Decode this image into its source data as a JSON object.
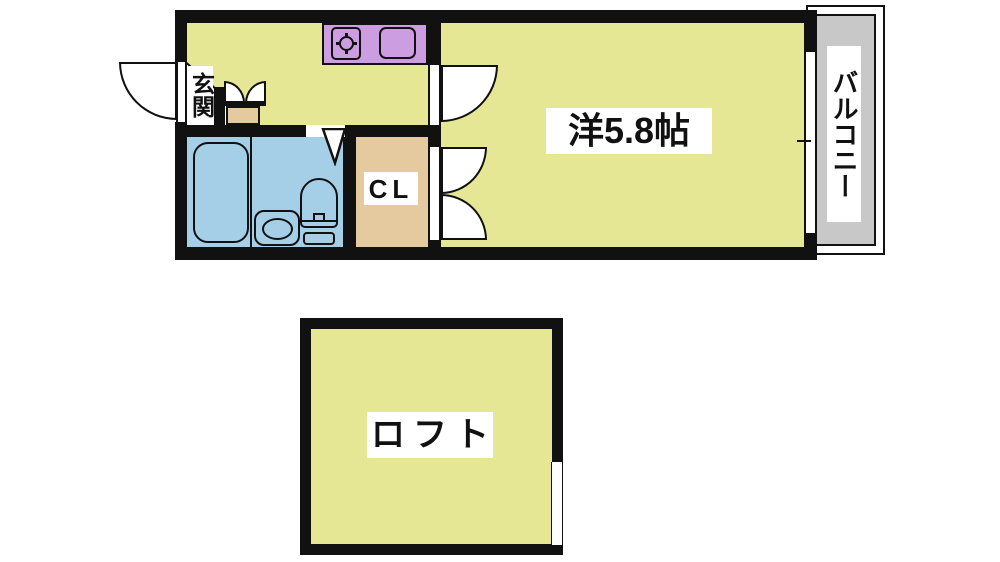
{
  "floorplan": {
    "labels": {
      "entrance": "玄関",
      "closet": "CL",
      "main_room": "洋5.8帖",
      "balcony": "バルコニー",
      "loft": "ロフト"
    },
    "colors": {
      "floor_yellow": "#E6E794",
      "bathroom_blue": "#A5CFE6",
      "closet_tan": "#E5CA9F",
      "kitchen_counter_purple": "#CC9DE0",
      "balcony_gray": "#C8C8C8",
      "wall_black": "#111111",
      "fixture_white": "#FFFFFF"
    }
  }
}
